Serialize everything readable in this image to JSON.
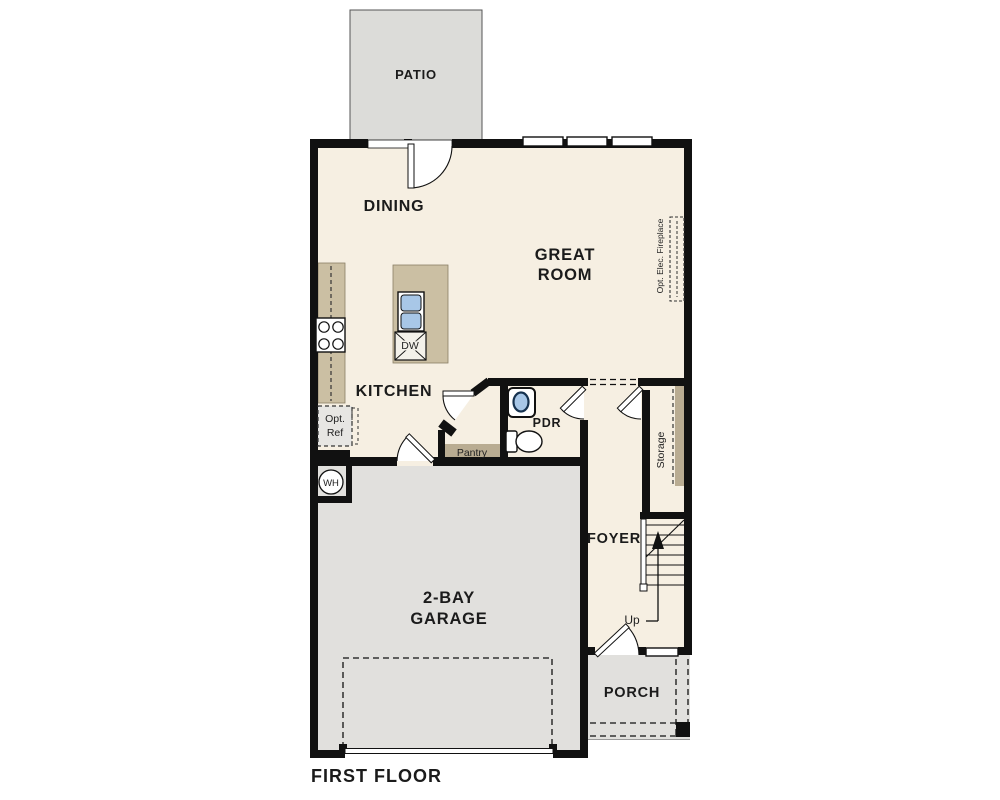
{
  "plan": {
    "title": "FIRST FLOOR",
    "rooms": {
      "patio": "PATIO",
      "dining": "DINING",
      "great_room": [
        "GREAT",
        "ROOM"
      ],
      "kitchen": "KITCHEN",
      "pdr": "PDR",
      "foyer": "FOYER",
      "garage": [
        "2-BAY",
        "GARAGE"
      ],
      "porch": "PORCH"
    },
    "labels": {
      "pantry": "Pantry",
      "storage": "Storage",
      "opt_ref": [
        "Opt.",
        "Ref"
      ],
      "water_heater": "WH",
      "dishwasher": "DW",
      "up": "Up",
      "fireplace": "Opt. Elec. Fireplace"
    },
    "colors": {
      "wall": "#111111",
      "floor": "#f6efe2",
      "counter_tan": "#cbbfa3",
      "shelf_tan": "#b9ac92",
      "concrete_gray": "#e1e0dd",
      "patio_gray": "#dcdcd9",
      "sink_blue": "#a8c7e7",
      "background": "#ffffff"
    }
  }
}
